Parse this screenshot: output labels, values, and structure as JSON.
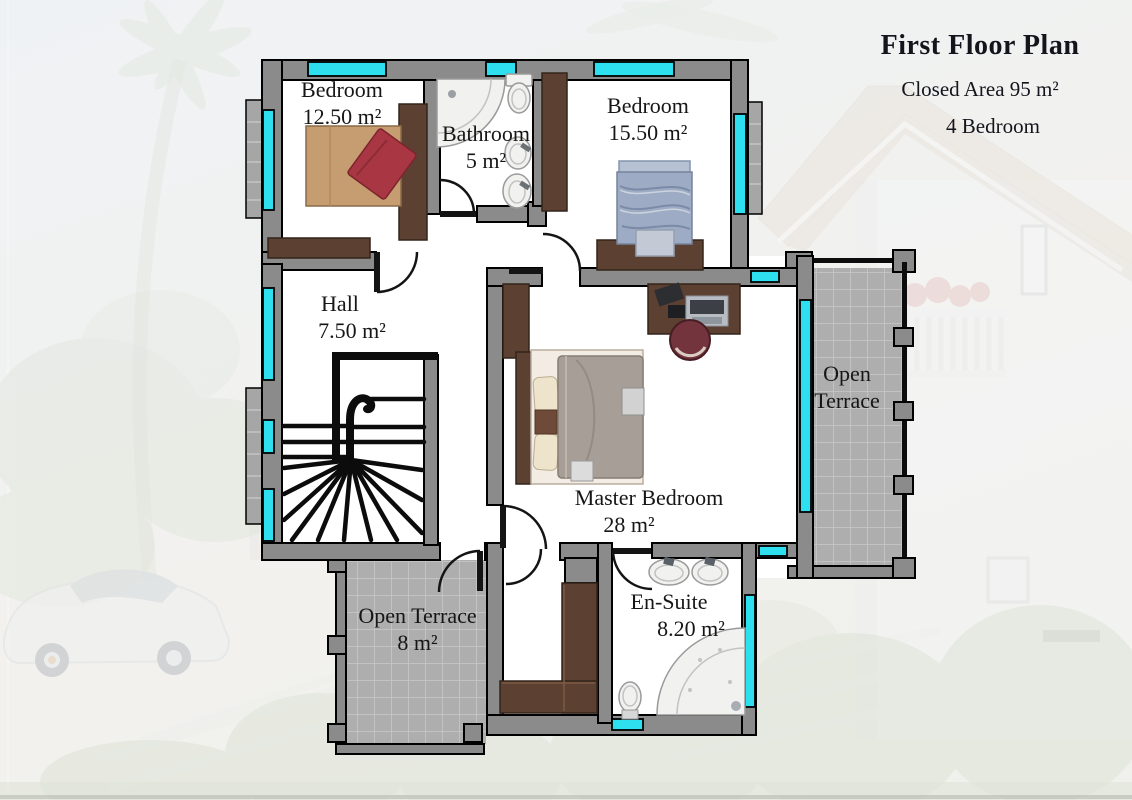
{
  "header": {
    "title": "First Floor Plan",
    "closed_area": "Closed Area 95 m²",
    "bedroom_count": "4 Bedroom"
  },
  "rooms": [
    {
      "id": "bedroom-1",
      "name": "Bedroom",
      "area": "12.50 m²"
    },
    {
      "id": "bathroom",
      "name": "Bathroom",
      "area": "5 m²"
    },
    {
      "id": "bedroom-2",
      "name": "Bedroom",
      "area": "15.50 m²"
    },
    {
      "id": "hall",
      "name": "Hall",
      "area": "7.50 m²"
    },
    {
      "id": "master-bedroom",
      "name": "Master Bedroom",
      "area": "28 m²"
    },
    {
      "id": "en-suite",
      "name": "En-Suite",
      "area": "8.20 m²"
    },
    {
      "id": "open-terrace-bottom",
      "name": "Open Terrace",
      "area": "8 m²"
    },
    {
      "id": "open-terrace-right",
      "name": "Open Terrace",
      "area": ""
    }
  ],
  "colors": {
    "wall": "#8b8b8b",
    "window": "#2edfef",
    "tile": "#aeaeae",
    "tile_line": "#c9c9c9",
    "wood": "#5c4133",
    "wood_dark": "#33241b",
    "accent_red": "#a83743",
    "bed_tan": "#c69d71",
    "bed_blue": "#9dabc4",
    "bed_gray": "#a79f97",
    "chair_maroon": "#74343e",
    "fixture": "#f1f1ef",
    "fixture_line": "#9a9a9a"
  }
}
